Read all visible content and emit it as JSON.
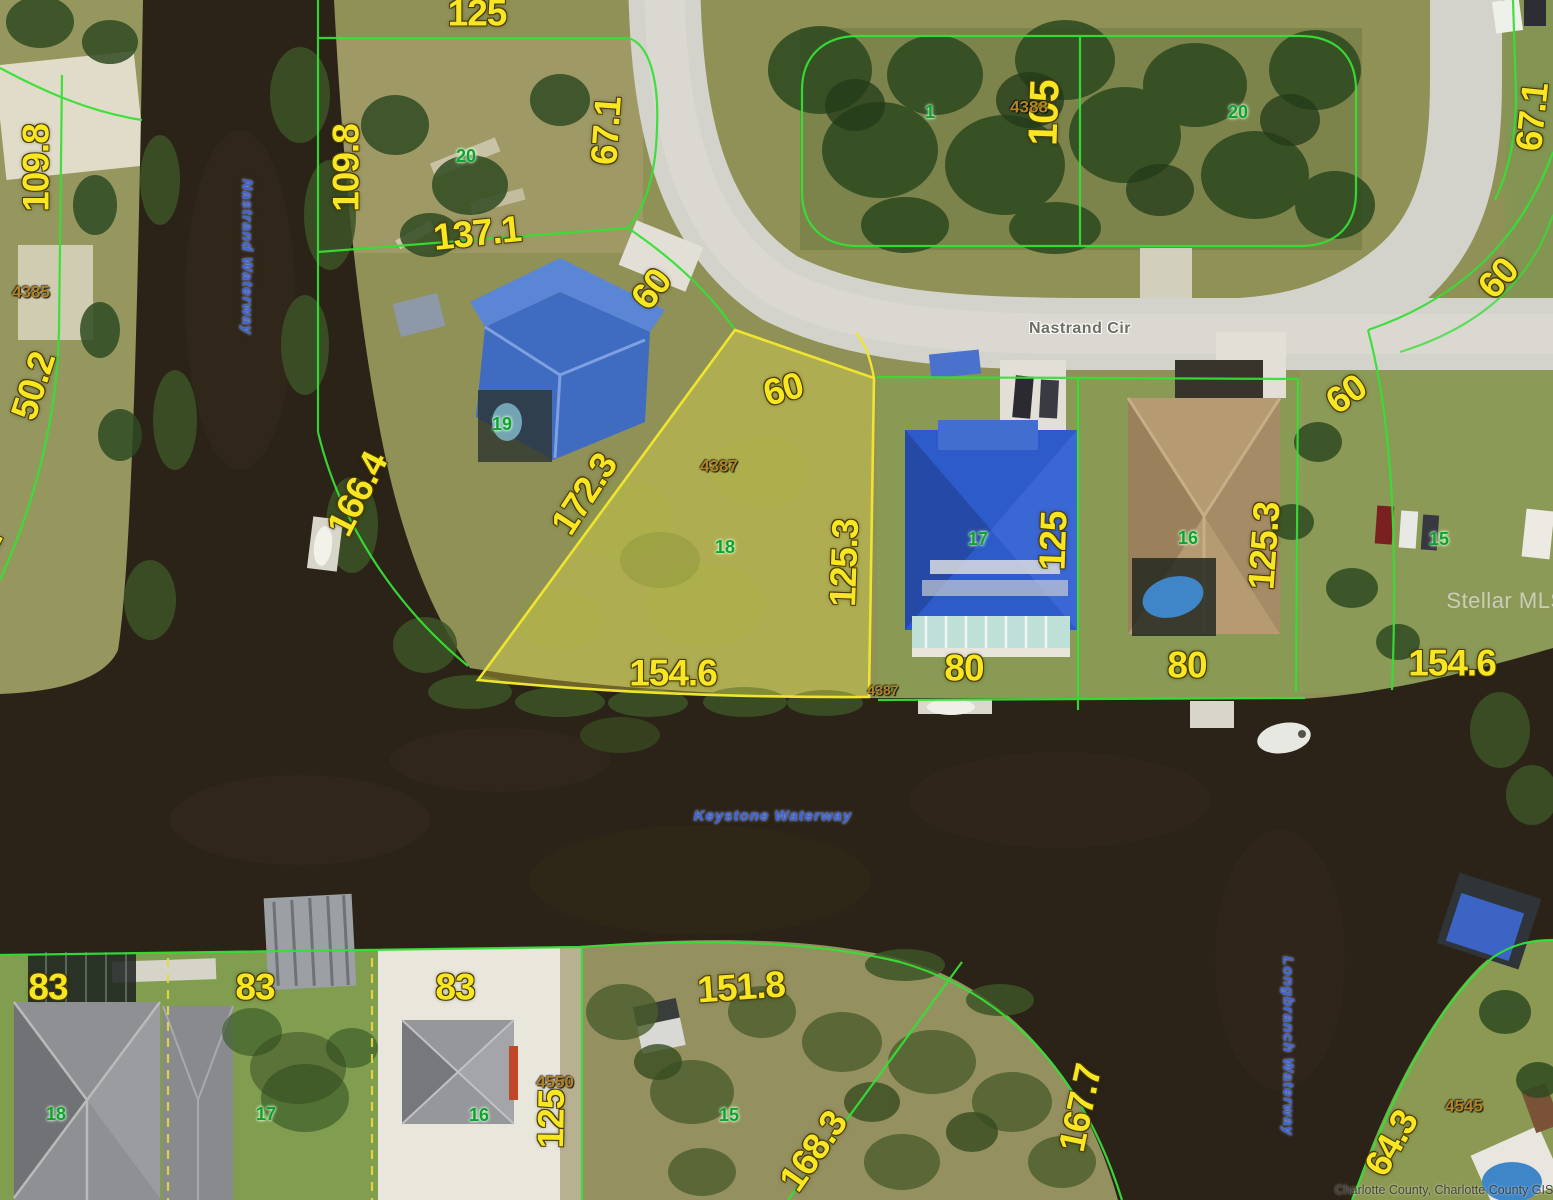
{
  "map": {
    "street_label": "Nastrand Cir",
    "waterway_names": [
      "Nastrand Waterway",
      "Keystone Waterway",
      "Longbranch Waterway"
    ],
    "highlighted_lot": {
      "lot_number": "18",
      "parcel_id": "4387",
      "dimensions": [
        "60",
        "125.3",
        "154.6",
        "172.3"
      ]
    },
    "watermark": "Stellar MLS",
    "credit": "Charlotte County, Charlotte County GIS",
    "colors": {
      "dimension_text": "#f8e622",
      "lot_number_text": "#0da32e",
      "parcel_id_text": "#b28428",
      "waterway_text": "#3c63d8",
      "parcel_line": "#36df36",
      "highlight_line": "#efe52f",
      "water": "#2b2317",
      "road": "#d4d3cb"
    },
    "labels": [
      {
        "k": "dim",
        "t": "125",
        "x": 477,
        "y": 13,
        "r": 0
      },
      {
        "k": "dim",
        "t": "109.8",
        "x": 36,
        "y": 168,
        "r": -90
      },
      {
        "k": "dim",
        "t": "109.8",
        "x": 346,
        "y": 168,
        "r": -90
      },
      {
        "k": "dim",
        "t": "67.1",
        "x": 606,
        "y": 131,
        "r": -86
      },
      {
        "k": "dim",
        "t": "137.1",
        "x": 477,
        "y": 233,
        "r": -6
      },
      {
        "k": "dim",
        "t": "50.2",
        "x": 33,
        "y": 386,
        "r": -72
      },
      {
        "k": "dim",
        "t": "50.2",
        "x": -24,
        "y": 562,
        "r": -62
      },
      {
        "k": "dim",
        "t": "166.4",
        "x": 357,
        "y": 494,
        "r": -63
      },
      {
        "k": "dim",
        "t": "60",
        "x": 651,
        "y": 289,
        "r": -52
      },
      {
        "k": "dim",
        "t": "172.3",
        "x": 584,
        "y": 494,
        "r": -57
      },
      {
        "k": "dim",
        "t": "60",
        "x": 783,
        "y": 389,
        "r": -15
      },
      {
        "k": "dim",
        "t": "125.3",
        "x": 844,
        "y": 563,
        "r": -88
      },
      {
        "k": "dim",
        "t": "154.6",
        "x": 673,
        "y": 673,
        "r": 0
      },
      {
        "k": "dim",
        "t": "105",
        "x": 1044,
        "y": 113,
        "r": -88,
        "s": 41
      },
      {
        "k": "dim",
        "t": "67.1",
        "x": 1532,
        "y": 117,
        "r": -84
      },
      {
        "k": "dim",
        "t": "60",
        "x": 1498,
        "y": 278,
        "r": -48
      },
      {
        "k": "dim",
        "t": "60",
        "x": 1346,
        "y": 394,
        "r": -35
      },
      {
        "k": "dim",
        "t": "125",
        "x": 1053,
        "y": 541,
        "r": -88
      },
      {
        "k": "dim",
        "t": "125.3",
        "x": 1264,
        "y": 546,
        "r": -86
      },
      {
        "k": "dim",
        "t": "80",
        "x": 964,
        "y": 668,
        "r": 0
      },
      {
        "k": "dim",
        "t": "80",
        "x": 1187,
        "y": 665,
        "r": 0
      },
      {
        "k": "dim",
        "t": "154.6",
        "x": 1452,
        "y": 663,
        "r": 0
      },
      {
        "k": "dim",
        "t": "83",
        "x": 48,
        "y": 987,
        "r": 0
      },
      {
        "k": "dim",
        "t": "83",
        "x": 255,
        "y": 987,
        "r": 0
      },
      {
        "k": "dim",
        "t": "83",
        "x": 455,
        "y": 987,
        "r": 0
      },
      {
        "k": "dim",
        "t": "125",
        "x": 551,
        "y": 1119,
        "r": -89
      },
      {
        "k": "dim",
        "t": "151.8",
        "x": 741,
        "y": 987,
        "r": -4
      },
      {
        "k": "dim",
        "t": "168.3",
        "x": 813,
        "y": 1151,
        "r": -55
      },
      {
        "k": "dim",
        "t": "167.7",
        "x": 1080,
        "y": 1108,
        "r": -78
      },
      {
        "k": "dim",
        "t": "64.3",
        "x": 1391,
        "y": 1143,
        "r": -60
      },
      {
        "k": "pid",
        "t": "4385",
        "x": 31,
        "y": 292,
        "r": 0
      },
      {
        "k": "pid",
        "t": "4387",
        "x": 719,
        "y": 466,
        "r": 0
      },
      {
        "k": "pid",
        "t": "4387",
        "x": 883,
        "y": 690,
        "r": 0,
        "s": 14
      },
      {
        "k": "pid",
        "t": "4388",
        "x": 1029,
        "y": 107,
        "r": 0
      },
      {
        "k": "pid",
        "t": "4550",
        "x": 555,
        "y": 1082,
        "r": 0
      },
      {
        "k": "pid",
        "t": "4545",
        "x": 1464,
        "y": 1106,
        "r": 0
      },
      {
        "k": "lot",
        "t": "20",
        "x": 466,
        "y": 156,
        "r": 0
      },
      {
        "k": "lot",
        "t": "1",
        "x": 930,
        "y": 112,
        "r": 0
      },
      {
        "k": "lot",
        "t": "20",
        "x": 1238,
        "y": 112,
        "r": 0
      },
      {
        "k": "lot",
        "t": "19",
        "x": 502,
        "y": 424,
        "r": 0
      },
      {
        "k": "lot",
        "t": "18",
        "x": 725,
        "y": 547,
        "r": 0
      },
      {
        "k": "lot",
        "t": "17",
        "x": 978,
        "y": 539,
        "r": 0
      },
      {
        "k": "lot",
        "t": "16",
        "x": 1188,
        "y": 538,
        "r": 0
      },
      {
        "k": "lot",
        "t": "15",
        "x": 1439,
        "y": 539,
        "r": 0
      },
      {
        "k": "lot",
        "t": "18",
        "x": 56,
        "y": 1114,
        "r": 0
      },
      {
        "k": "lot",
        "t": "17",
        "x": 266,
        "y": 1114,
        "r": 0
      },
      {
        "k": "lot",
        "t": "16",
        "x": 479,
        "y": 1115,
        "r": 0
      },
      {
        "k": "lot",
        "t": "15",
        "x": 729,
        "y": 1115,
        "r": 0
      },
      {
        "k": "water",
        "t": "Nastrand Waterway",
        "x": 247,
        "y": 257,
        "r": 90
      },
      {
        "k": "water",
        "t": "Keystone Waterway",
        "x": 773,
        "y": 816,
        "r": 0
      },
      {
        "k": "water",
        "t": "Longbranch Waterway",
        "x": 1288,
        "y": 1046,
        "r": 90
      },
      {
        "k": "street",
        "t": "Nastrand Cir",
        "x": 1080,
        "y": 329,
        "r": 0
      },
      {
        "k": "wm",
        "t": "Stellar MLS",
        "x": 1506,
        "y": 601,
        "r": 0
      },
      {
        "k": "credit",
        "t": "Charlotte County, Charlotte County GIS",
        "x": 1444,
        "y": 1190,
        "r": 0
      }
    ]
  }
}
